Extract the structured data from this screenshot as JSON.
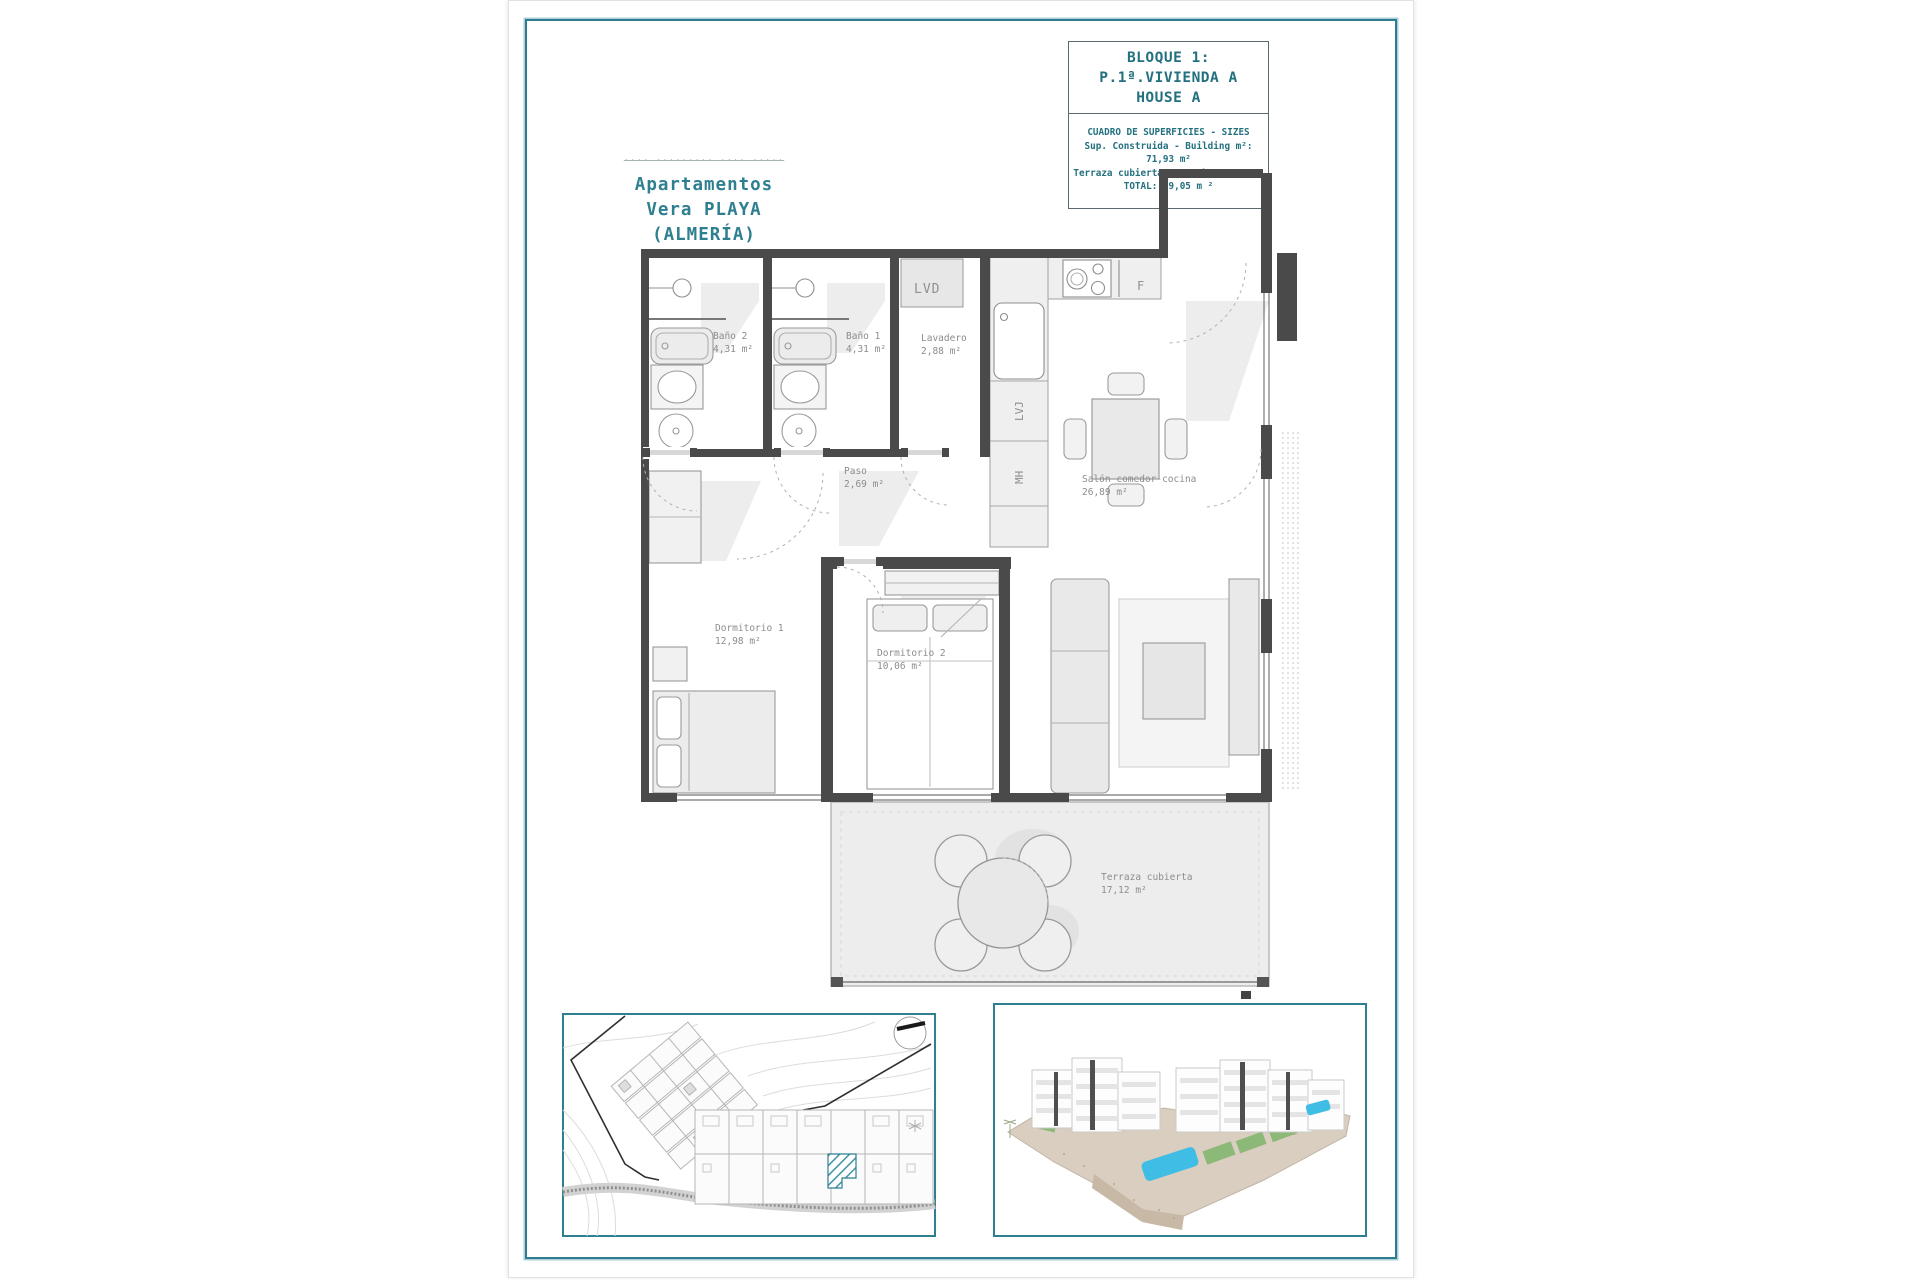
{
  "sheet": {
    "brand": {
      "watermark": "···· ········· ···· ·····",
      "line1": "Apartamentos",
      "line2": "Vera PLAYA",
      "line3": "(ALMERÍA)"
    },
    "title_block": {
      "block_line1": "BLOQUE 1:",
      "block_line2": "P.1ª.VIVIENDA A",
      "block_line3": "HOUSE A",
      "table_header": "CUADRO DE SUPERFICIES  - SIZES",
      "row_built": "Sup. Construida  - Building m²:  71,93 m²",
      "row_terrace": "Terraza cubierta  - Porch:  17,12 m²",
      "row_total": "TOTAL:  89,05 m ²"
    },
    "plan": {
      "rooms": {
        "bano2_name": "Baño 2",
        "bano2_area": "4,31 m²",
        "bano1_name": "Baño 1",
        "bano1_area": "4,31 m²",
        "lavadero_name": "Lavadero",
        "lavadero_area": "2,88 m²",
        "paso_name": "Paso",
        "paso_area": "2,69 m²",
        "salon_name": "Salón-comedor-cocina",
        "salon_area": "26,89 m²",
        "dorm1_name": "Dormitorio 1",
        "dorm1_area": "12,98 m²",
        "dorm2_name": "Dormitorio 2",
        "dorm2_area": "10,06 m²",
        "terraza_name": "Terraza cubierta",
        "terraza_area": "17,12 m²"
      },
      "appliances": {
        "washer": "LVD",
        "dishwasher": "LVJ",
        "microwave": "MH",
        "fridge": "F"
      }
    },
    "colors": {
      "accent_teal": "#2e7c90",
      "teal_text": "#23707f",
      "wall_gray": "#4a4a4a",
      "label_gray": "#8c8c8c",
      "hatch_teal": "#3f93a5"
    }
  }
}
